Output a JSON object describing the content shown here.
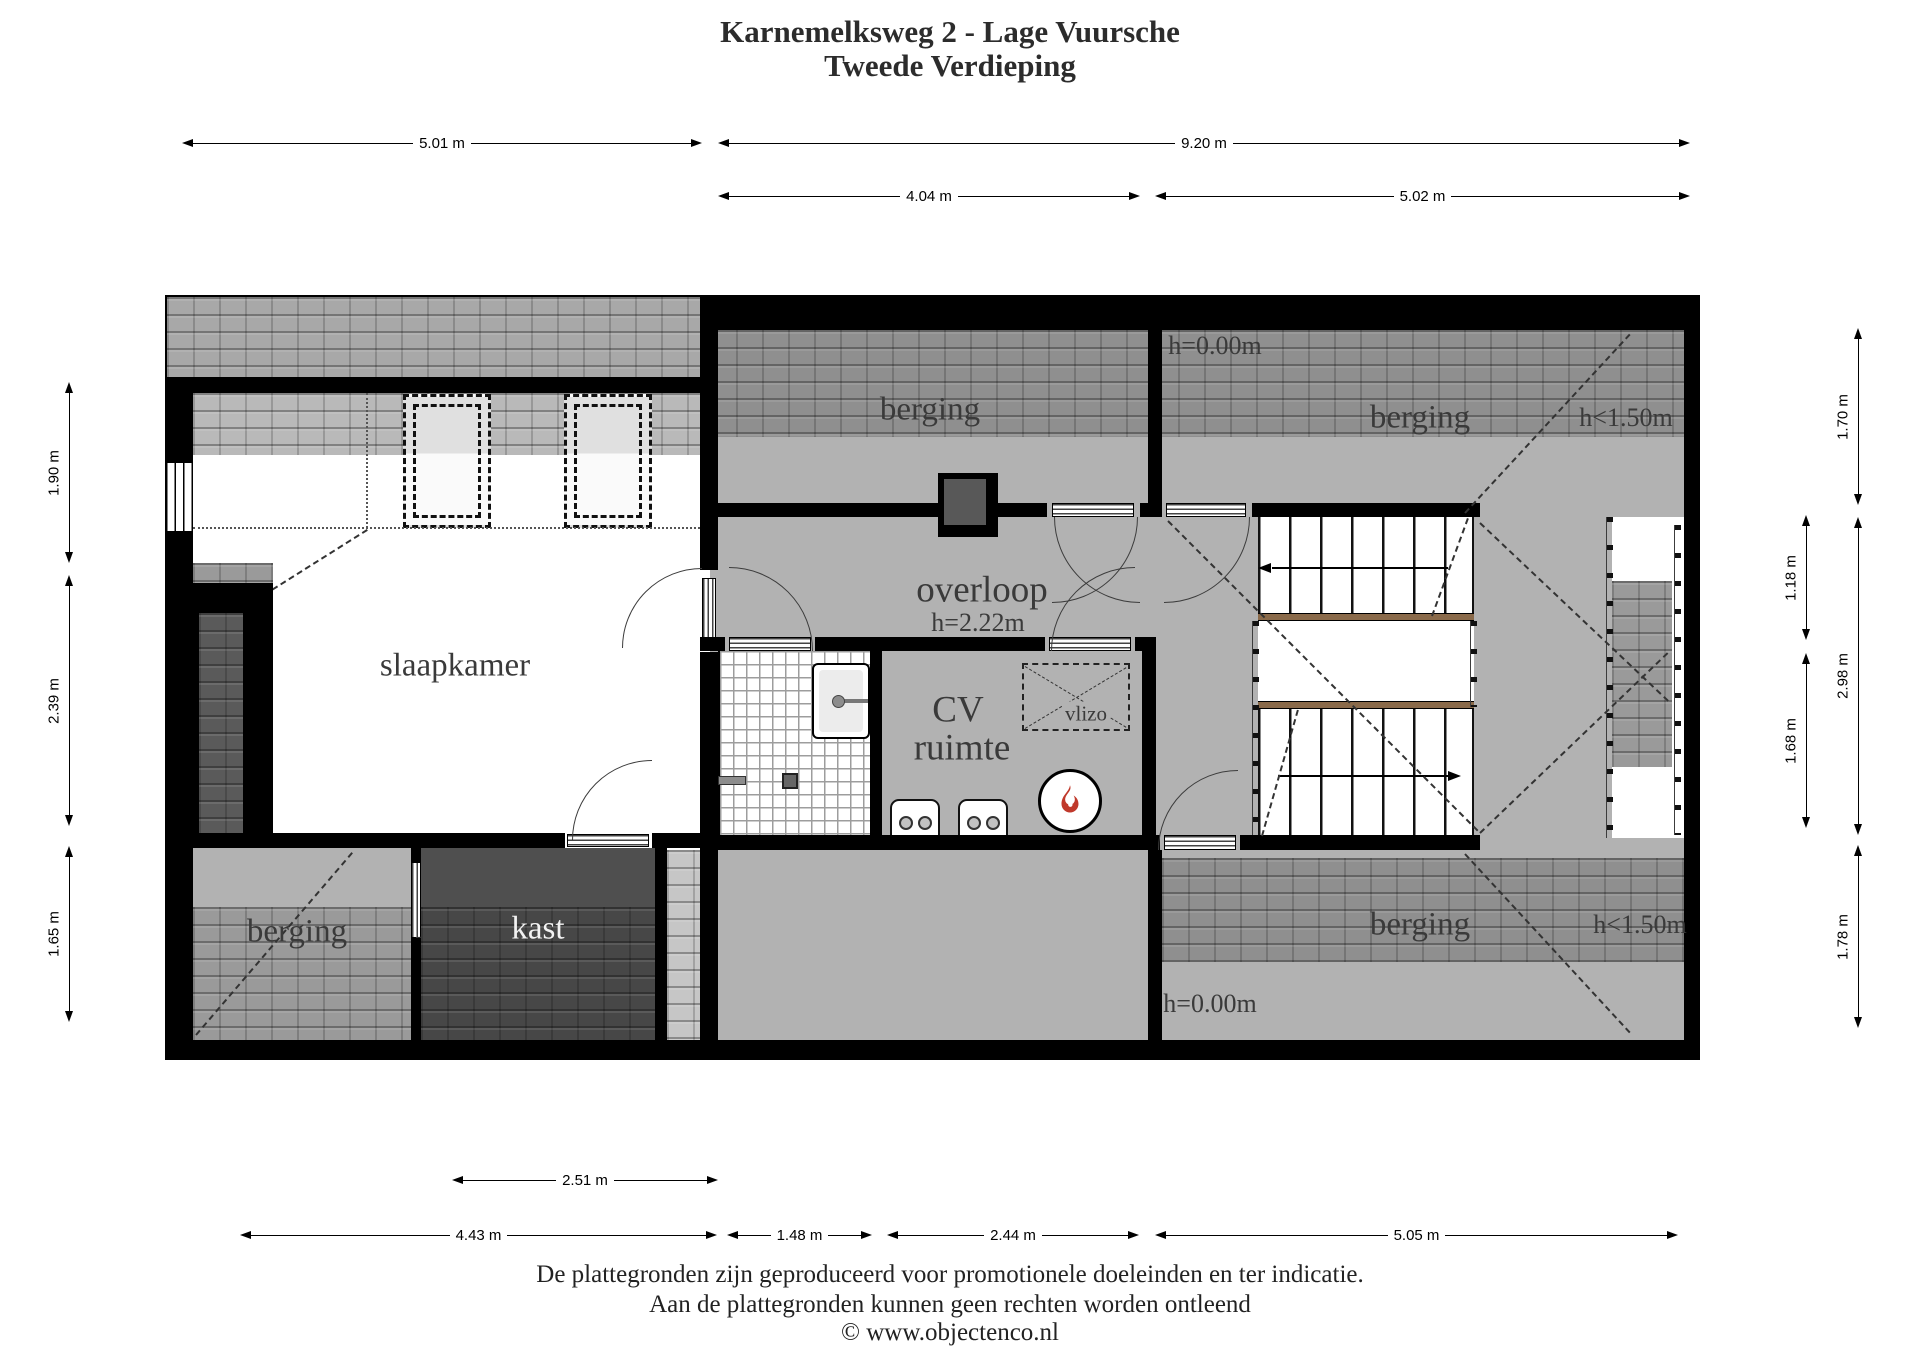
{
  "title": {
    "line1": "Karnemelksweg 2 - Lage Vuursche",
    "line2": "Tweede Verdieping"
  },
  "labels": {
    "slaapkamer": "slaapkamer",
    "berging_top_left": "berging",
    "berging_top_right": "berging",
    "berging_bottom_left": "berging",
    "berging_bottom_right": "berging",
    "kast": "kast",
    "overloop": "overloop",
    "overloop_height": "h=2.22m",
    "cv_line1": "CV",
    "cv_line2": "ruimte",
    "vlizo": "vlizo",
    "h_zero_top": "h=0.00m",
    "h_max150_top": "h<1.50m",
    "h_zero_bottom": "h=0.00m",
    "h_max150_bottom": "h<1.50m"
  },
  "dimensions": {
    "top_left_width": "5.01 m",
    "top_right_width": "9.20 m",
    "mid_width_1": "4.04 m",
    "mid_width_2": "5.02 m",
    "left_height_1": "1.90 m",
    "left_height_2": "2.39 m",
    "left_height_3": "1.65 m",
    "right_inner_height_1": "1.18 m",
    "right_inner_height_2": "1.68 m",
    "right_outer_height_1": "1.70 m",
    "right_outer_height_2": "2.98 m",
    "right_outer_height_3": "1.78 m",
    "bottom_kast_width": "2.51 m",
    "bottom_width_1": "4.43 m",
    "bottom_width_2": "1.48 m",
    "bottom_width_3": "2.44 m",
    "bottom_width_4": "5.05 m"
  },
  "footer": {
    "line1": "De plattegronden zijn geproduceerd voor promotionele doeleinden en ter indicatie.",
    "line2": "Aan de plattegronden kunnen geen rechten worden ontleend",
    "line3": "© www.objectenco.nl"
  },
  "colors": {
    "wall": "#000000",
    "floor_gray": "#b2b2b2",
    "roof_tile_dark": "#8f8f8f",
    "roof_tile_light": "#c6c6c6",
    "kast_dark": "#4f4f4f",
    "stair_edge": "#8a6a4a",
    "flame_red": "#c0392b"
  }
}
